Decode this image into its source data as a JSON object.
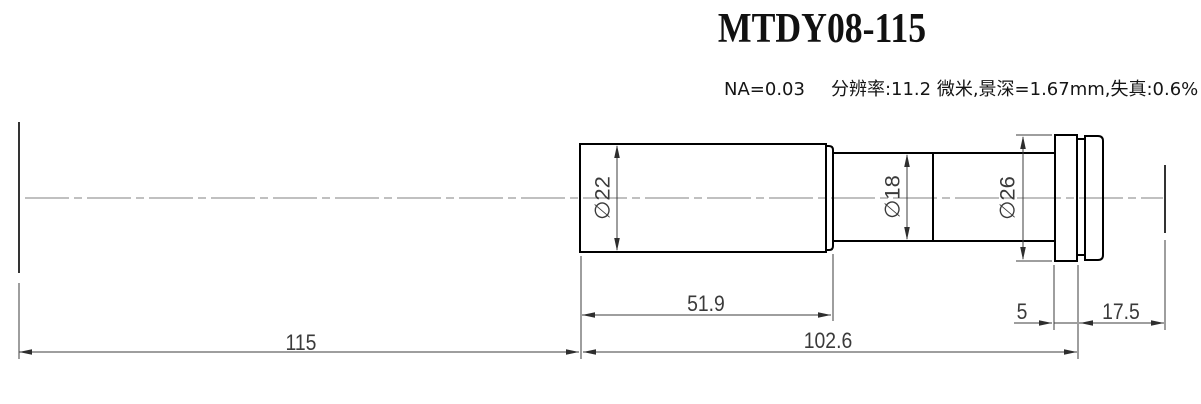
{
  "title": "MTDY08-115",
  "specs": {
    "na": "NA=0.03",
    "optics": "分辨率:11.2 微米,景深=1.67mm,失真:0.6%"
  },
  "dimensions": {
    "working_distance": "115",
    "total_length": "102.6",
    "front_length": "51.9",
    "flange_thickness": "5",
    "back_length": "17.5",
    "front_diameter": "∅22",
    "mid_diameter": "∅18",
    "flange_diameter": "∅26"
  },
  "colors": {
    "outline": "#000000",
    "dimension": "#3c3c3c",
    "centerline": "#808080"
  }
}
